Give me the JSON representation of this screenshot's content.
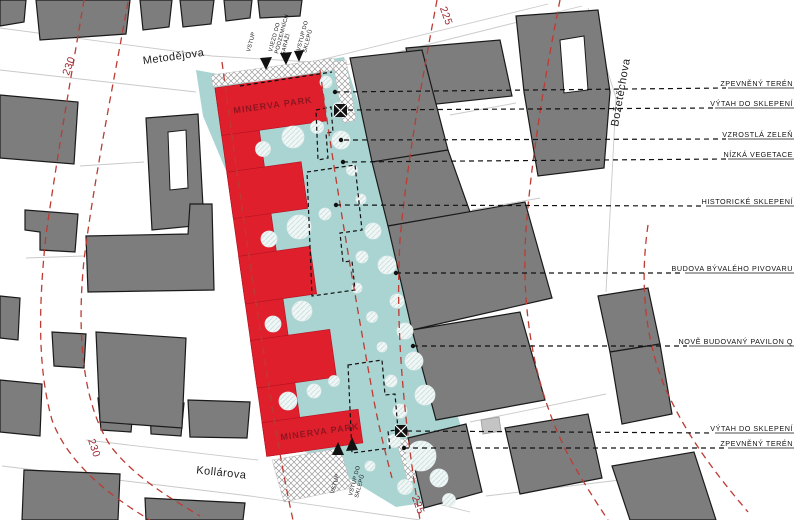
{
  "streets": {
    "metodejova": "Metodějova",
    "kollarova": "Kollárova",
    "bozetechova": "Božetěchova"
  },
  "contours": [
    "230",
    "225",
    "230",
    "225"
  ],
  "site": {
    "minerva_top": "MINERVA PARK",
    "minerva_bottom": "MINERVA PARK"
  },
  "entrances": {
    "top": [
      "VSTUP",
      "VJEZD DO",
      "PODZEMNÍCH",
      "GARÁŽÍ",
      "VSTUP DO",
      "SKLEPŮ"
    ],
    "bottom": [
      "VSTUP",
      "VSTUP DO",
      "SKLEPŮ"
    ]
  },
  "legend": {
    "items": [
      {
        "label": "ZPEVNĚNÝ TERÉN"
      },
      {
        "label": "VÝTAH DO SKLEPENÍ"
      },
      {
        "label": "VZROSTLÁ ZELEŇ"
      },
      {
        "label": "NÍZKÁ VEGETACE"
      },
      {
        "label": "HISTORICKÉ SKLEPENÍ"
      },
      {
        "label": "BUDOVA BÝVALÉHO PIVOVARU"
      },
      {
        "label": "NOVĚ BUDOVANÝ PAVILON Q"
      },
      {
        "label": "VÝTAH DO SKLEPENÍ"
      },
      {
        "label": "ZPEVNĚNÝ TERÉN"
      }
    ]
  },
  "colors": {
    "building_red": "#e01f2d",
    "park_teal": "#a9d4d2",
    "building_gray": "#7d7d7d",
    "contour_red": "#bd3b33",
    "minerva_dark_red": "#8e1620"
  }
}
